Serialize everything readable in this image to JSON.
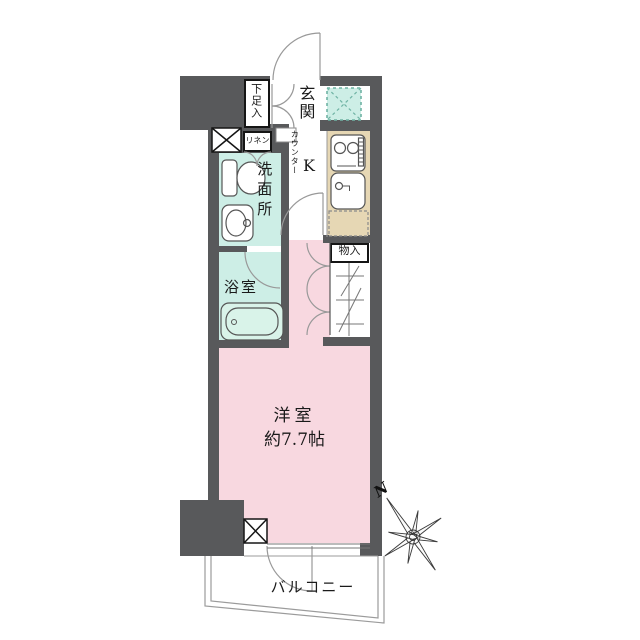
{
  "floorplan": {
    "labels": {
      "entrance": "玄関",
      "shoe_storage": "下足入",
      "linen": "リネン",
      "counter": "カウンター",
      "kitchen": "K",
      "washroom": "洗面所",
      "bathroom": "浴室",
      "storage": "物入",
      "western_room_name": "洋室",
      "western_room_size": "約7.7帖",
      "balcony": "バルコニー",
      "compass_north": "N"
    },
    "colors": {
      "wall": "#58595b",
      "western_room": "#f8d8e0",
      "wet_area": "#cdeee6",
      "kitchen_counter": "#e6d7b4"
    }
  }
}
